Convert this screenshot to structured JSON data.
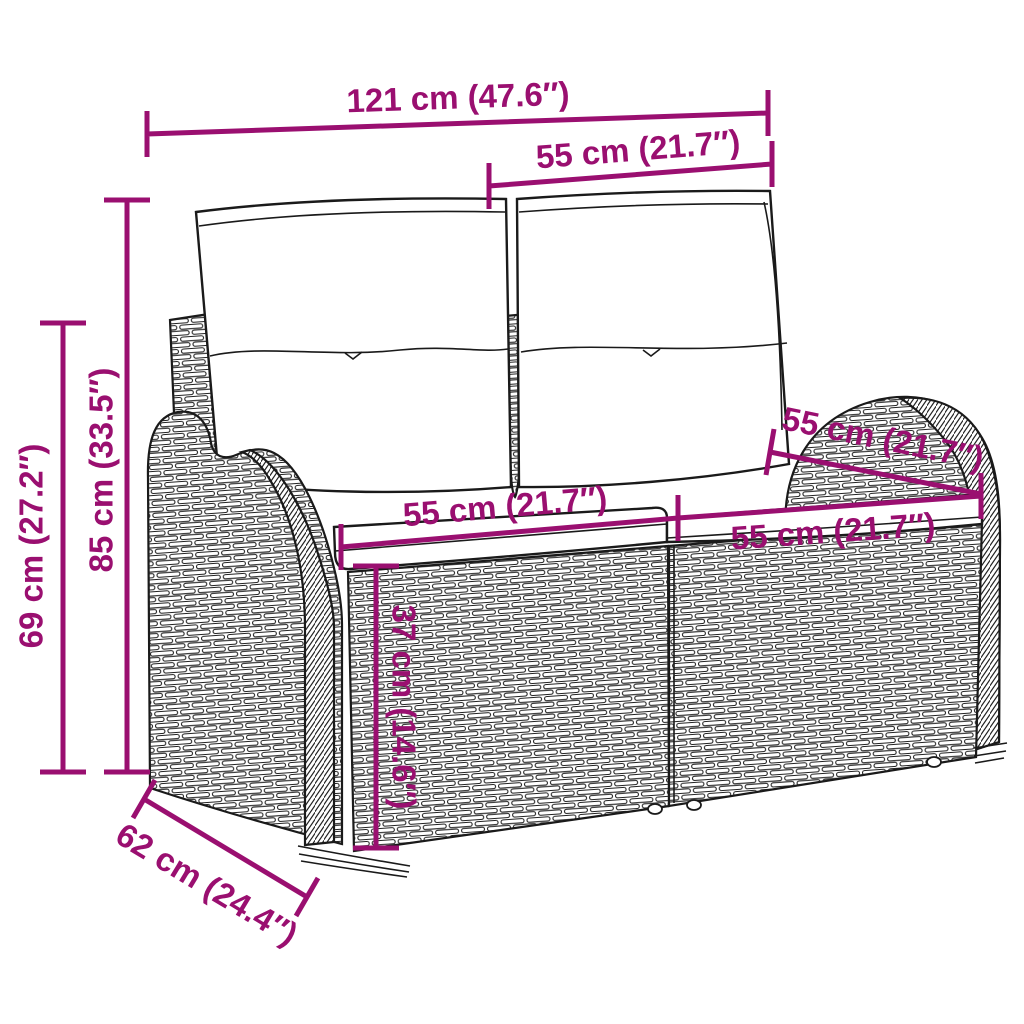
{
  "diagram": {
    "title": "Garden bench dimension diagram",
    "product": "2-seater poly rattan garden sofa with cushions",
    "accent_color": "#9a0f70",
    "outline_color": "#1a1a1a",
    "background_color": "#ffffff",
    "dimensions": {
      "overall_width": "121 cm (47.6″)",
      "back_cushion_width": "55 cm (21.7″)",
      "total_height": "85 cm (33.5″)",
      "arm_height": "69 cm (27.2″)",
      "seat_width_left": "55 cm (21.7″)",
      "seat_width_right": "55 cm (21.7″)",
      "seat_depth": "55 cm (21.7″)",
      "seat_height": "37 cm (14.6″)",
      "overall_depth": "62 cm (24.4″)"
    }
  }
}
